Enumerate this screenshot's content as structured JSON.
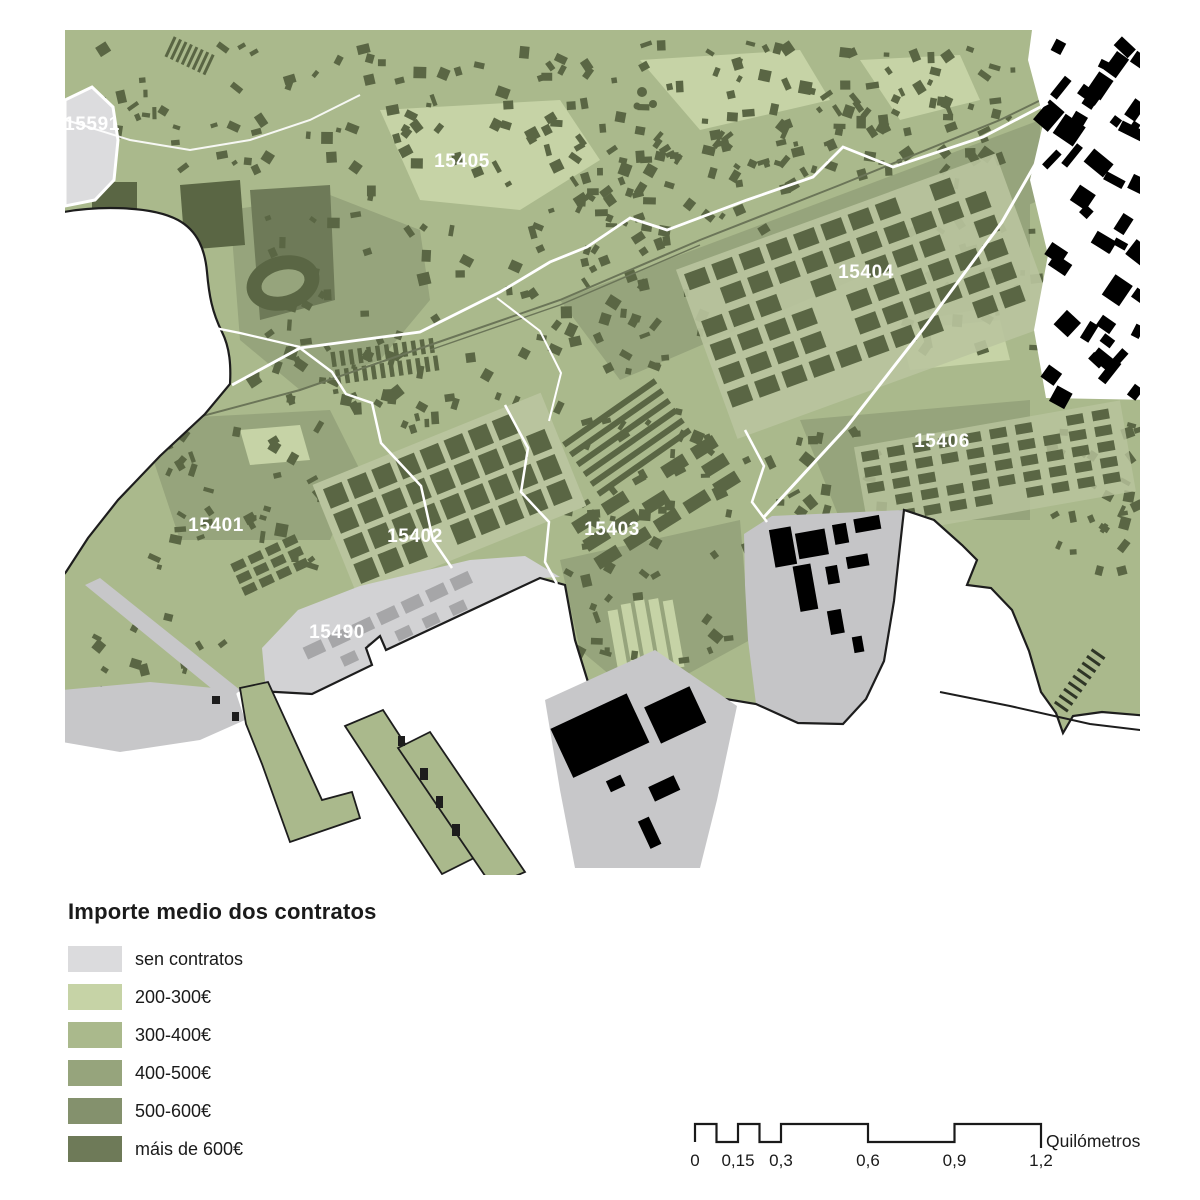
{
  "legend": {
    "title": "Importe medio dos contratos",
    "items": [
      {
        "label": "sen contratos",
        "color": "#dbdbdd"
      },
      {
        "label": "200-300€",
        "color": "#c6d3a6"
      },
      {
        "label": "300-400€",
        "color": "#aab98c"
      },
      {
        "label": "400-500€",
        "color": "#96a47c"
      },
      {
        "label": "500-600€",
        "color": "#84916d"
      },
      {
        "label": "máis de 600€",
        "color": "#6e7a58"
      }
    ]
  },
  "map": {
    "district_labels": [
      {
        "code": "15591",
        "x": 92,
        "y": 130
      },
      {
        "code": "15405",
        "x": 462,
        "y": 167
      },
      {
        "code": "15404",
        "x": 866,
        "y": 278
      },
      {
        "code": "15406",
        "x": 942,
        "y": 447
      },
      {
        "code": "15401",
        "x": 216,
        "y": 531
      },
      {
        "code": "15402",
        "x": 415,
        "y": 542
      },
      {
        "code": "15403",
        "x": 612,
        "y": 535
      },
      {
        "code": "15490",
        "x": 337,
        "y": 638
      }
    ],
    "label_color": "#ffffff",
    "land_color": "#aab98c",
    "street_color": "#b9c49e",
    "building_color": "#5a6644",
    "water_color": "#ffffff",
    "coast_outline": "#1d1d1d",
    "no_data_color": "#d4d4d6",
    "outside_building_color": "#000000"
  },
  "scalebar": {
    "ticks": [
      {
        "label": "0",
        "km": 0
      },
      {
        "label": "0,15",
        "km": 0.15
      },
      {
        "label": "0,3",
        "km": 0.3
      },
      {
        "label": "0,6",
        "km": 0.6
      },
      {
        "label": "0,9",
        "km": 0.9
      },
      {
        "label": "1,2",
        "km": 1.2
      }
    ],
    "unit": "Quilómetros"
  }
}
